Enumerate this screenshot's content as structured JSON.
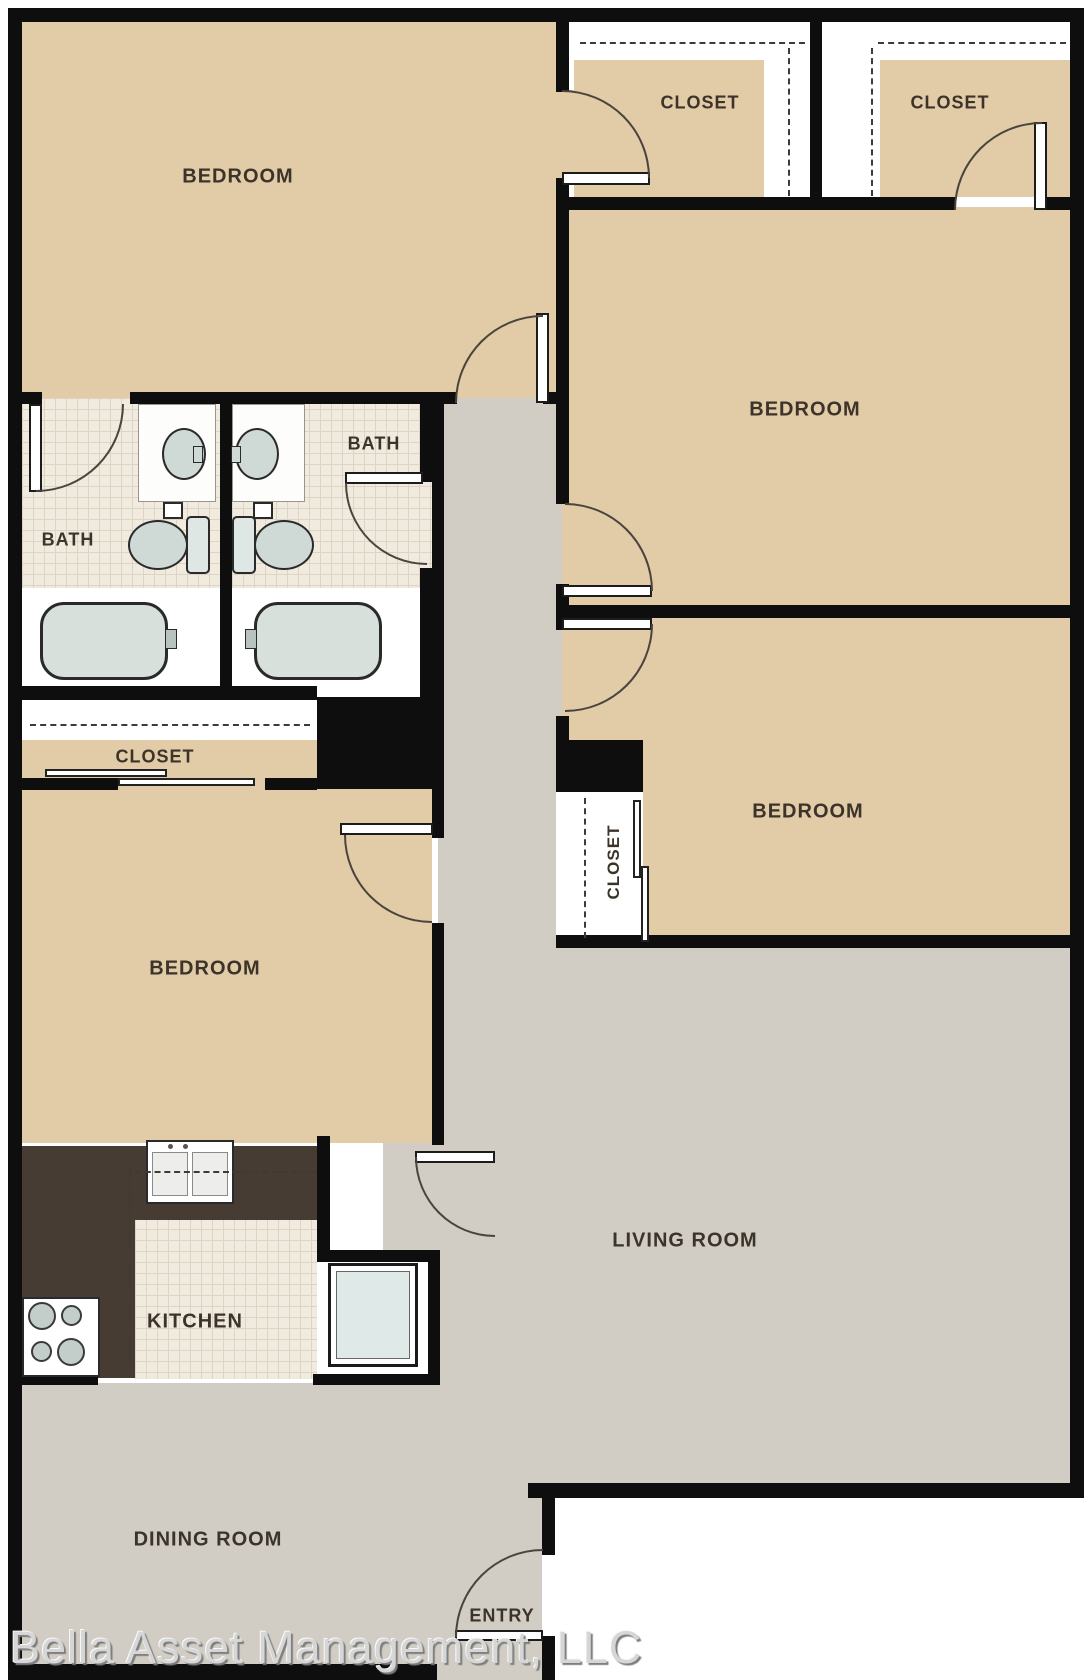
{
  "rooms": {
    "bedroom1": "BEDROOM",
    "bedroom2": "BEDROOM",
    "bedroom3": "BEDROOM",
    "bedroom4": "BEDROOM",
    "closet1": "CLOSET",
    "closet2": "CLOSET",
    "closet3": "CLOSET",
    "closet4": "CLOSET",
    "bath1": "BATH",
    "bath2": "BATH",
    "kitchen": "KITCHEN",
    "living_room": "LIVING ROOM",
    "dining_room": "DINING ROOM",
    "entry": "ENTRY"
  },
  "watermark": "Bella Asset Management, LLC",
  "colors": {
    "wall": "#0e0e0e",
    "room_tan": "#e2cba7",
    "floor_gray": "#d1cdc4",
    "tile": "#f1ebdf",
    "tile_line": "#ddd5c3",
    "counter": "#473c33",
    "fixture": "#cfd9d5",
    "line": "#4a443d",
    "label": "#3c332a",
    "watermark": "#d6d6d6"
  }
}
